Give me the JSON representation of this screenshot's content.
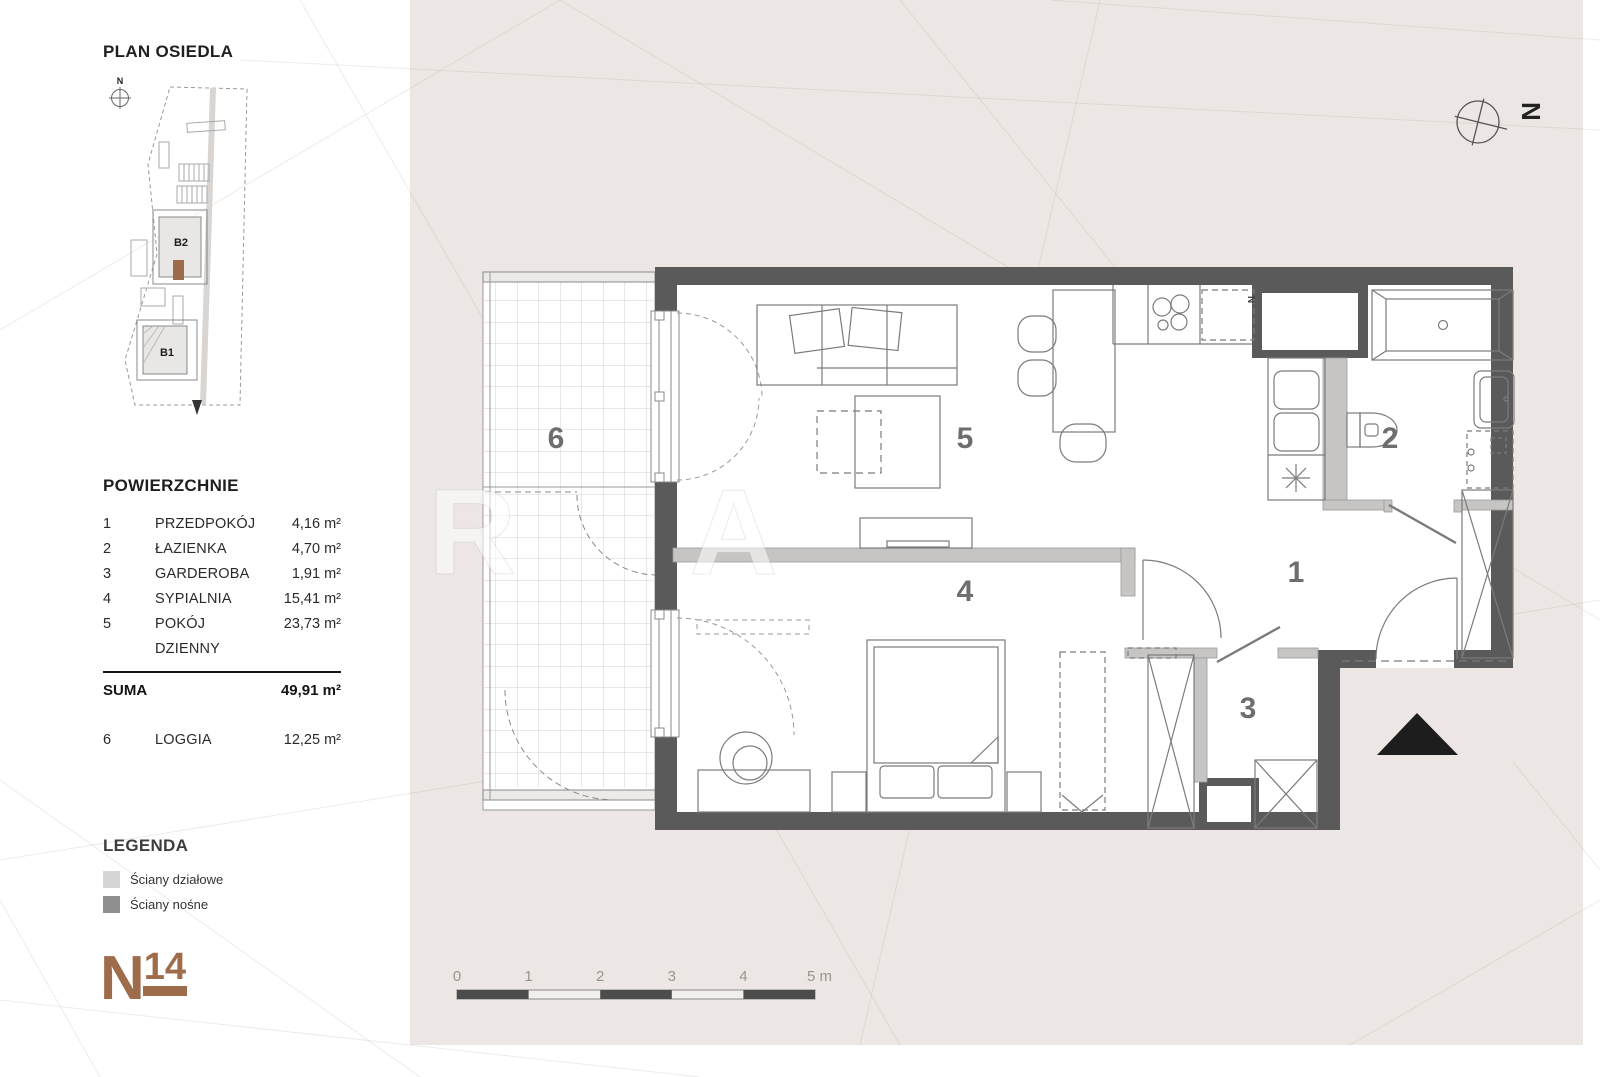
{
  "sidebar": {
    "site_plan": {
      "title": "PLAN OSIEDLA",
      "compass": "N",
      "building_top": "B2",
      "building_bottom": "B1"
    },
    "areas": {
      "title": "POWIERZCHNIE",
      "rows": [
        {
          "no": "1",
          "name": "PRZEDPOKÓJ",
          "area": "4,16 m²"
        },
        {
          "no": "2",
          "name": "ŁAZIENKA",
          "area": "4,70 m²"
        },
        {
          "no": "3",
          "name": "GARDEROBA",
          "area": "1,91 m²"
        },
        {
          "no": "4",
          "name": "SYPIALNIA",
          "area": "15,41 m²"
        },
        {
          "no": "5",
          "name": "POKÓJ DZIENNY",
          "area": "23,73 m²"
        }
      ],
      "suma": {
        "label": "SUMA",
        "value": "49,91 m²"
      },
      "loggia": {
        "no": "6",
        "name": "LOGGIA",
        "area": "12,25 m²"
      }
    },
    "legend": {
      "title": "LEGENDA",
      "items": [
        {
          "label": "Ściany działowe",
          "color": "#d8d6d4"
        },
        {
          "label": "Ściany nośne",
          "color": "#8f8f8f"
        }
      ]
    },
    "logo": {
      "letter": "N",
      "number": "14",
      "color": "#9e6c4a"
    }
  },
  "plan": {
    "compass": "N",
    "rooms": {
      "r1": "1",
      "r2": "2",
      "r3": "3",
      "r4": "4",
      "r5": "5",
      "r6": "6"
    },
    "fridge_label": "N",
    "scale": {
      "labels": [
        "0",
        "1",
        "2",
        "3",
        "4",
        "5 m"
      ]
    },
    "watermark": "R A",
    "colors": {
      "background": "#ece7e4",
      "wall_load_bearing": "#5a5a5a",
      "wall_partition": "#c7c5c3",
      "accent_brown": "#9e6c4a"
    }
  }
}
